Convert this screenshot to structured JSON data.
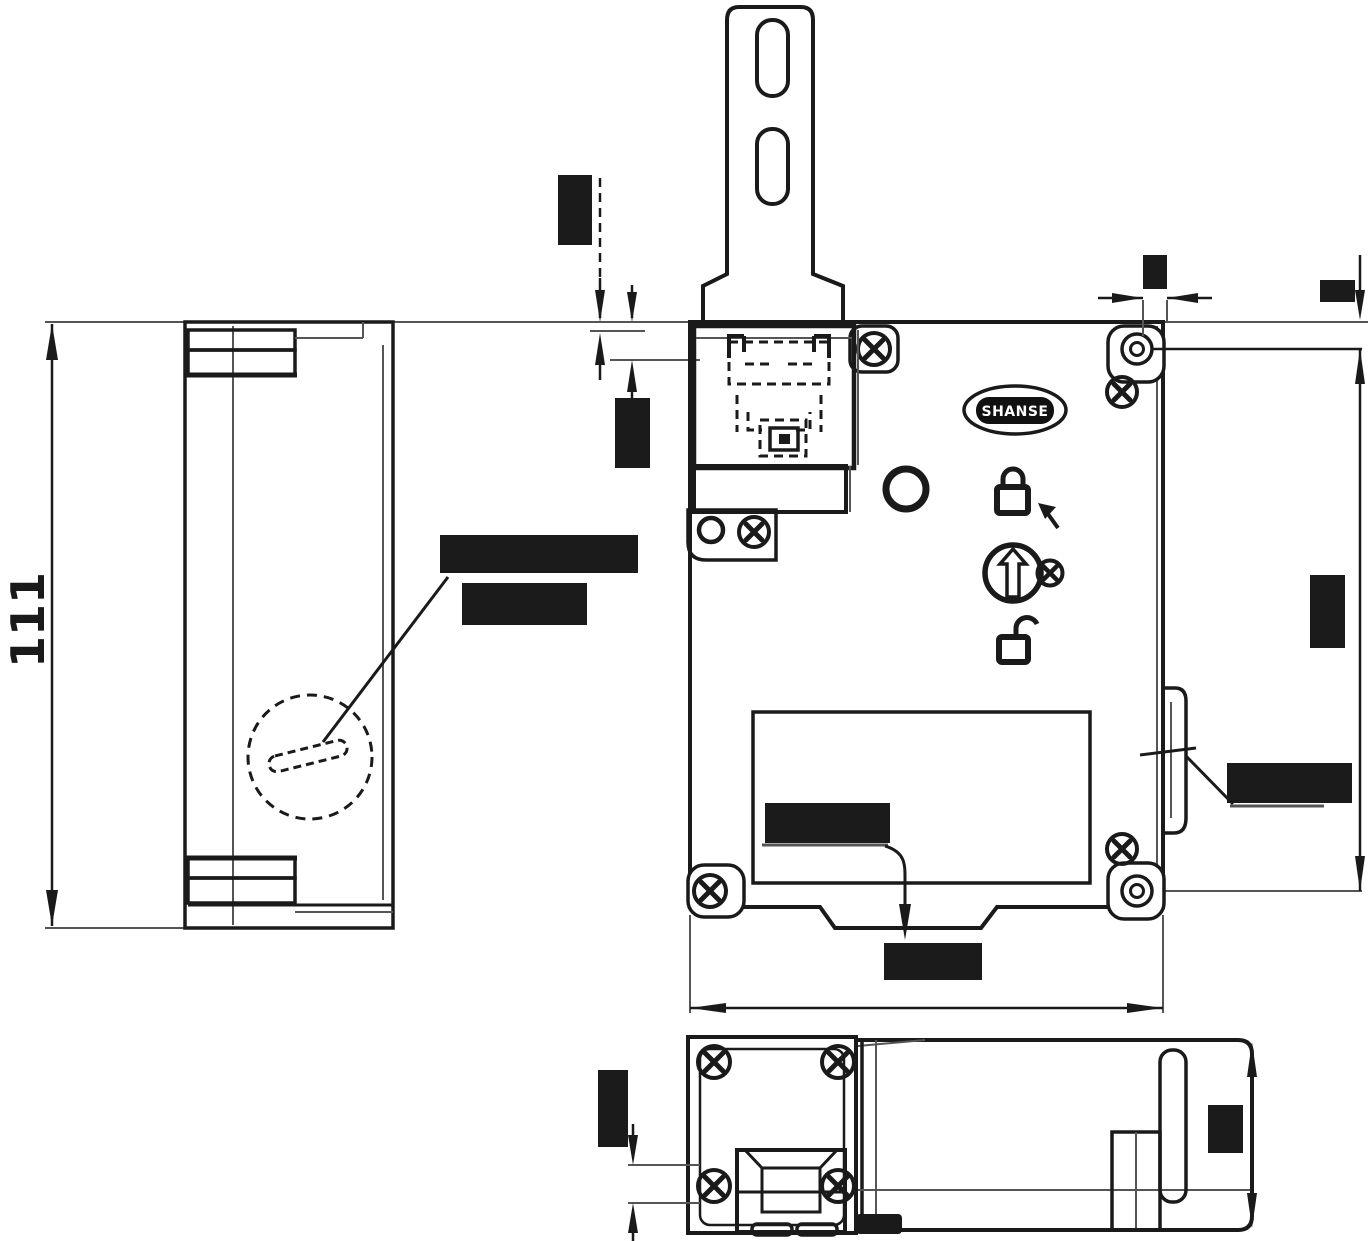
{
  "page": {
    "background": "#ffffff"
  },
  "palette": {
    "line": "#1a1a1a",
    "construction": "#555555",
    "redaction": "#1b1b1b",
    "logo_fill": "#111111",
    "logo_text_color": "#ffffff"
  },
  "side_view": {
    "height_dimension_label": "111"
  },
  "front_view": {
    "logo_text": "SHANSE",
    "icons": [
      "padlock-locked-icon",
      "pointer-arrow-icon",
      "rotary-selector-icon",
      "selector-screw-icon",
      "padlock-unlocked-icon"
    ]
  },
  "redacted_regions": [
    {
      "id": "actuator-entry-dim",
      "orientation": "vertical"
    },
    {
      "id": "head-face-dim",
      "orientation": "vertical"
    },
    {
      "id": "manual-release-label-line1",
      "orientation": "horizontal"
    },
    {
      "id": "manual-release-label-line2",
      "orientation": "horizontal"
    },
    {
      "id": "hole-offset-dim",
      "orientation": "horizontal"
    },
    {
      "id": "top-right-dim",
      "orientation": "horizontal"
    },
    {
      "id": "mounting-height-dim",
      "orientation": "vertical"
    },
    {
      "id": "side-clip-label",
      "orientation": "horizontal"
    },
    {
      "id": "cover-label",
      "orientation": "horizontal"
    },
    {
      "id": "overall-width-dim",
      "orientation": "horizontal"
    },
    {
      "id": "bottom-view-left-dim",
      "orientation": "vertical"
    },
    {
      "id": "bottom-view-depth-dim",
      "orientation": "vertical"
    }
  ]
}
